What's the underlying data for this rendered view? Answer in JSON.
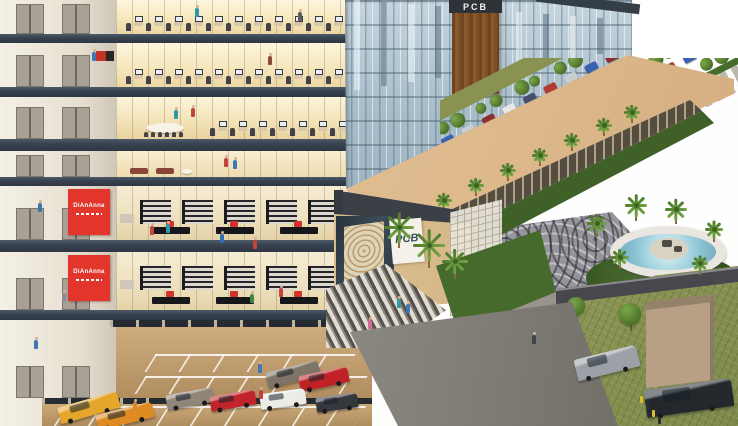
{
  "signs": {
    "tower_sign": "PCB",
    "entrance_sign": "PCB"
  },
  "colors": {
    "slab": "#39434f",
    "facade_glass": "#a8bdca",
    "canopy": "#ddb98c",
    "retail_sign_red": "#e2352b",
    "interior_warm": "#f6e7bd",
    "core_wall": "#efe9dd",
    "fountain_water": "#8fc6d6",
    "lawn_green": "#8d9655",
    "plaza_gray": "#96959b",
    "wood_column": "#8a5a2c"
  },
  "scene": {
    "floors": [
      {
        "kind": "office",
        "y": 0,
        "h": 34
      },
      {
        "kind": "office",
        "y": 43,
        "h": 44,
        "artwork": true
      },
      {
        "kind": "meeting",
        "y": 97,
        "h": 42
      },
      {
        "kind": "lounge",
        "y": 151,
        "h": 26
      },
      {
        "kind": "retail",
        "y": 186,
        "h": 54,
        "sign": "DiAnAnna"
      },
      {
        "kind": "retail",
        "y": 252,
        "h": 58,
        "sign": "DiAnAnna"
      },
      {
        "kind": "garage",
        "y": 320,
        "h": 78
      },
      {
        "kind": "garage2",
        "y": 398,
        "h": 28
      }
    ],
    "slabs": [
      {
        "y": 34,
        "h": 9
      },
      {
        "y": 87,
        "h": 10
      },
      {
        "y": 139,
        "h": 12
      },
      {
        "y": 177,
        "h": 9
      },
      {
        "y": 240,
        "h": 12
      },
      {
        "y": 310,
        "h": 10
      }
    ],
    "garage_cars_upper": [
      {
        "x": 266,
        "y": 366,
        "w": 54,
        "h": 16,
        "c": "#7e7467",
        "r": -14
      },
      {
        "x": 299,
        "y": 371,
        "w": 50,
        "h": 16,
        "c": "#bf2127",
        "r": -12
      }
    ],
    "garage_cars_lower": [
      {
        "x": 58,
        "y": 399,
        "w": 62,
        "h": 17,
        "c": "#e5a72b",
        "r": -16
      },
      {
        "x": 96,
        "y": 408,
        "w": 58,
        "h": 16,
        "c": "#df8a22",
        "r": -14
      },
      {
        "x": 166,
        "y": 391,
        "w": 48,
        "h": 15,
        "c": "#8f8678",
        "r": -10
      },
      {
        "x": 210,
        "y": 393,
        "w": 46,
        "h": 15,
        "c": "#c2242b",
        "r": -10
      },
      {
        "x": 260,
        "y": 391,
        "w": 46,
        "h": 16,
        "c": "#ecebe6",
        "r": -8
      },
      {
        "x": 316,
        "y": 395,
        "w": 42,
        "h": 15,
        "c": "#34383c",
        "r": -8
      }
    ],
    "lawn_cars": [
      {
        "x": 575,
        "y": 352,
        "w": 64,
        "h": 22,
        "c": "#9ba1a6",
        "r": -14
      },
      {
        "x": 645,
        "y": 384,
        "w": 88,
        "h": 28,
        "c": "#23282c",
        "r": -8
      }
    ],
    "lot_car_colors": [
      "#b23a32",
      "#3a62b0",
      "#c9cdd1",
      "#8d2f2f",
      "#e8e8ea",
      "#44506b",
      "#b23a32",
      "#c9cdd1",
      "#3a62b0",
      "#8d2f2f",
      "#d8d8da",
      "#3a62b0",
      "#b23a32",
      "#c9cdd1"
    ],
    "arcade_palms": [
      [
        412,
        216
      ],
      [
        444,
        201
      ],
      [
        476,
        186
      ],
      [
        508,
        171
      ],
      [
        540,
        156
      ],
      [
        572,
        141
      ],
      [
        604,
        126
      ],
      [
        632,
        113
      ]
    ],
    "fountain_palms": [
      [
        597,
        224,
        1.1
      ],
      [
        636,
        206,
        1.25
      ],
      [
        676,
        210,
        1.2
      ],
      [
        714,
        230,
        1.0
      ],
      [
        700,
        264,
        0.9
      ],
      [
        620,
        258,
        0.95
      ]
    ],
    "entrance_palms": [
      [
        399,
        228,
        1.7
      ],
      [
        429,
        246,
        1.8
      ],
      [
        455,
        262,
        1.4
      ]
    ],
    "lawn_trees": [
      [
        576,
        306,
        9
      ],
      [
        630,
        314,
        11
      ]
    ],
    "bollards": [
      [
        640,
        396
      ],
      [
        646,
        403
      ],
      [
        652,
        410
      ],
      [
        658,
        417
      ]
    ],
    "people": [
      [
        195,
        8,
        "#2f9aa6"
      ],
      [
        298,
        12,
        "#5a5f66"
      ],
      [
        92,
        52,
        "#3f76b4"
      ],
      [
        268,
        56,
        "#8a4a3a"
      ],
      [
        174,
        110,
        "#2f9aa6"
      ],
      [
        191,
        108,
        "#c2443a"
      ],
      [
        224,
        158,
        "#c2443a"
      ],
      [
        233,
        160,
        "#3f76b4"
      ],
      [
        38,
        203,
        "#3f76b4"
      ],
      [
        150,
        226,
        "#c2443a"
      ],
      [
        166,
        224,
        "#2f9aa6"
      ],
      [
        220,
        234,
        "#2e6fb0"
      ],
      [
        253,
        240,
        "#c2443a"
      ],
      [
        62,
        293,
        "#8a8f96"
      ],
      [
        250,
        294,
        "#3a8a46"
      ],
      [
        279,
        288,
        "#c2443a"
      ],
      [
        34,
        340,
        "#3f76b4"
      ],
      [
        258,
        364,
        "#3f76b4"
      ],
      [
        259,
        390,
        "#c2443a"
      ],
      [
        133,
        402,
        "#d8892a"
      ],
      [
        368,
        320,
        "#d46a9a"
      ],
      [
        406,
        304,
        "#3f76b4"
      ],
      [
        397,
        299,
        "#2f9aa6"
      ],
      [
        532,
        335,
        "#41444a"
      ]
    ]
  }
}
